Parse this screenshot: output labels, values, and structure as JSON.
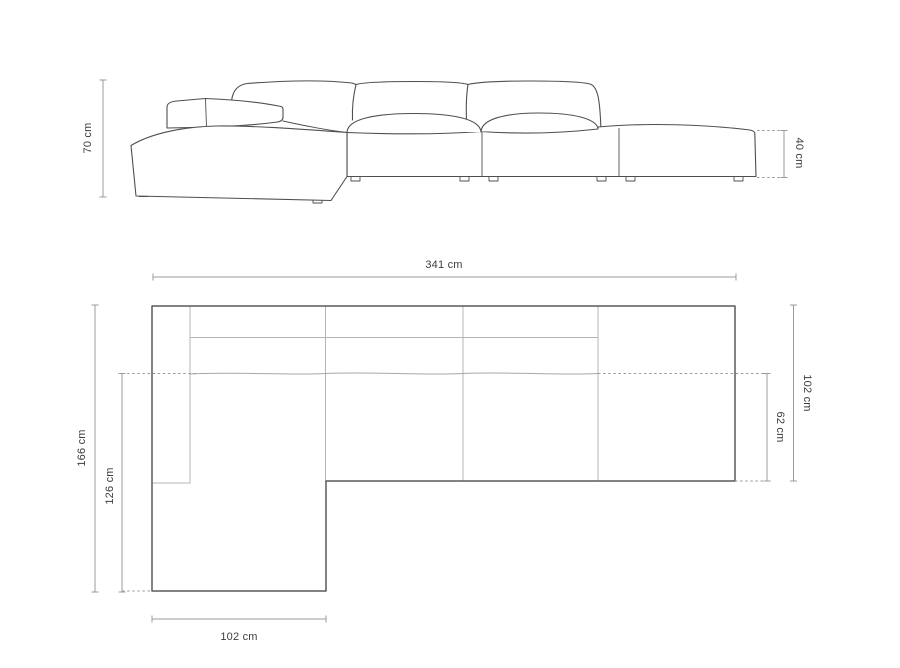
{
  "diagram": {
    "front_elevation": {
      "labels": {
        "sofa_height": "70 cm",
        "ottoman_height": "40 cm"
      }
    },
    "top_plan": {
      "labels": {
        "total_width": "341 cm",
        "total_depth": "166 cm",
        "chaise_extension_depth": "126 cm",
        "body_depth": "102 cm",
        "seat_depth": "62 cm",
        "chaise_width": "102 cm"
      }
    },
    "colors": {
      "background": "#ffffff",
      "sofa_outline": "#4f4f4f",
      "plan_outline": "#5a5a5a",
      "inner_line": "#b4b4b4",
      "dimension_line": "#9b9b9b",
      "label_text": "#3d3d3d"
    }
  }
}
